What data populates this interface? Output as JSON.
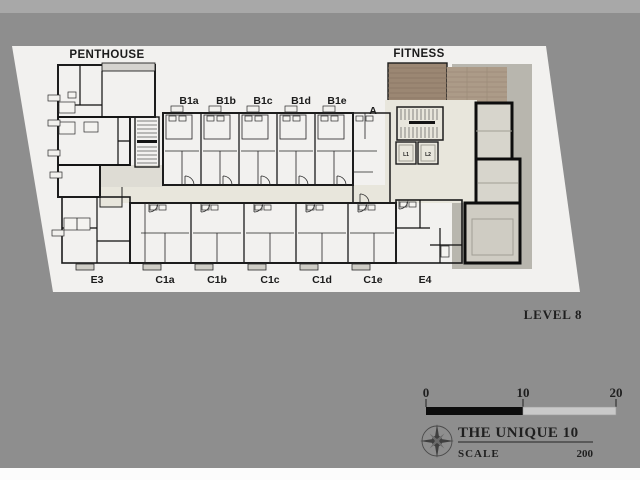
{
  "background": {
    "main": "#8e8e8e",
    "top_strip": "#a8a8a8",
    "bottom_strip": "#fcfcfc"
  },
  "palette": {
    "paper": "#f2f1ef",
    "penthouse": "#504e4b",
    "roof_ledge": "#d5d3cf",
    "unit_b": "#a9a7a2",
    "unit_b_bath": "#b5b3ae",
    "unit_a": "#eae8e0",
    "unit_c": "#8f8e8a",
    "unit_e": "#6f6d69",
    "corridor": "#e8e6dc",
    "entry": "#dedcd4",
    "core": "#d9d7cf",
    "elevator": "#ccc9c1",
    "wood_dark": "#9b8773",
    "wood_light": "#ac9b88",
    "terrace_band": "#b8b6ae",
    "glass_room_upper": "#d7d5cc",
    "glass_room_lower": "#cfccc3"
  },
  "plan": {
    "penthouse_label": "PENTHOUSE",
    "fitness_label": "FITNESS",
    "top_units": [
      "B1a",
      "B1b",
      "B1c",
      "B1d",
      "B1e"
    ],
    "unit_a_label": "A",
    "bottom_units": [
      "E3",
      "C1a",
      "C1b",
      "C1c",
      "C1d",
      "C1e",
      "E4"
    ],
    "elevators": [
      "L1",
      "L2"
    ]
  },
  "annotations": {
    "level": "LEVEL 8"
  },
  "scale_bar": {
    "ticks": [
      "0",
      "10",
      "20"
    ]
  },
  "title_block": {
    "project": "THE UNIQUE 10",
    "scale_label": "SCALE",
    "scale_value": "200"
  }
}
